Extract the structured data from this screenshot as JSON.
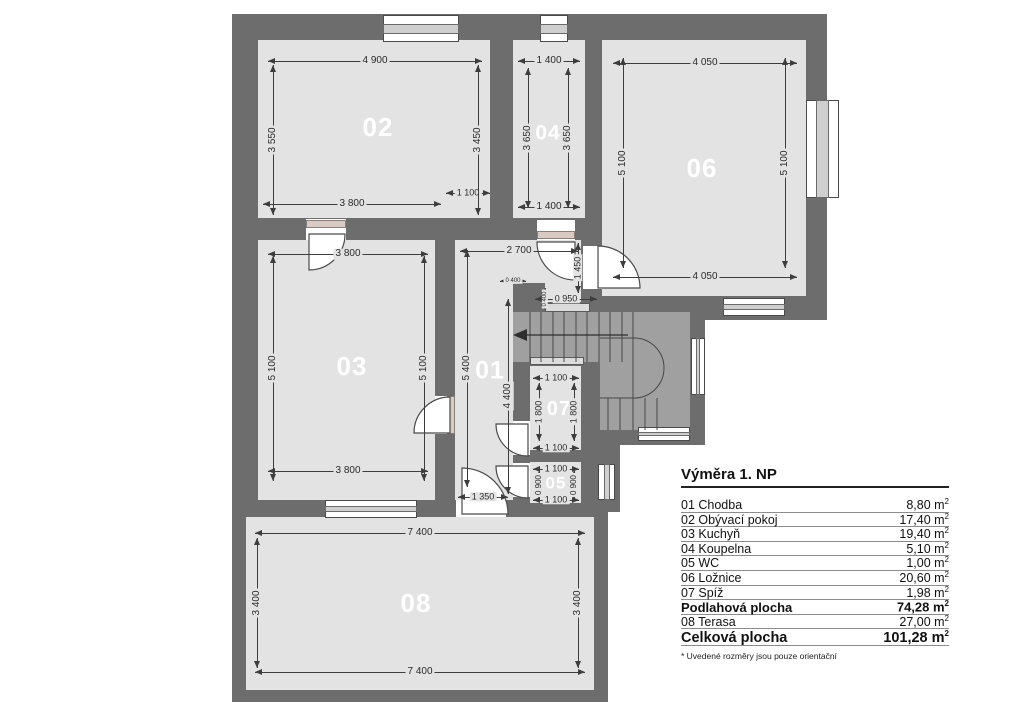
{
  "drawing": {
    "type": "floor-plan",
    "floor": "1. NP"
  },
  "legend": {
    "title": "Výměra 1. NP",
    "unit": "m",
    "unit_sup": "2",
    "rows": [
      {
        "label": "01 Chodba",
        "area": "8,80",
        "bold": false,
        "big": false
      },
      {
        "label": "02 Obývací pokoj",
        "area": "17,40",
        "bold": false,
        "big": false
      },
      {
        "label": "03 Kuchyň",
        "area": "19,40",
        "bold": false,
        "big": false
      },
      {
        "label": "04 Koupelna",
        "area": "5,10",
        "bold": false,
        "big": false
      },
      {
        "label": "05 WC",
        "area": "1,00",
        "bold": false,
        "big": false
      },
      {
        "label": "06 Ložnice",
        "area": "20,60",
        "bold": false,
        "big": false
      },
      {
        "label": "07 Spíž",
        "area": "1,98",
        "bold": false,
        "big": false
      },
      {
        "label": "Podlahová plocha",
        "area": "74,28",
        "bold": true,
        "big": false
      },
      {
        "label": "08 Terasa",
        "area": "27,00",
        "bold": false,
        "big": false
      },
      {
        "label": "Celková plocha",
        "area": "101,28",
        "bold": true,
        "big": true
      }
    ],
    "footnote": "* Uvedené rozměry jsou pouze orientační"
  },
  "rooms": [
    {
      "number": "02",
      "name": "Obývací pokoj",
      "x": 378,
      "y": 127,
      "size": 26
    },
    {
      "number": "04",
      "name": "Koupelna",
      "x": 548,
      "y": 133,
      "size": 21
    },
    {
      "number": "06",
      "name": "Ložnice",
      "x": 702,
      "y": 168,
      "size": 26
    },
    {
      "number": "03",
      "name": "Kuchyň",
      "x": 352,
      "y": 366,
      "size": 26
    },
    {
      "number": "01",
      "name": "Chodba",
      "x": 490,
      "y": 371,
      "size": 25
    },
    {
      "number": "07",
      "name": "Spíž",
      "x": 559,
      "y": 409,
      "size": 20
    },
    {
      "number": "05",
      "name": "WC",
      "x": 556,
      "y": 483,
      "size": 17
    },
    {
      "number": "08",
      "name": "Terasa",
      "x": 416,
      "y": 603,
      "size": 26
    }
  ],
  "dimensions": [
    {
      "text": "4 900",
      "o": "h",
      "x": 375,
      "y": 61,
      "len": 214
    },
    {
      "text": "1 400",
      "o": "h",
      "x": 549,
      "y": 61,
      "len": 62
    },
    {
      "text": "4 050",
      "o": "h",
      "x": 705,
      "y": 63,
      "len": 184
    },
    {
      "text": "1 100",
      "o": "h",
      "x": 468,
      "y": 193,
      "len": 44,
      "fs": 9
    },
    {
      "text": "3 800",
      "o": "h",
      "x": 352,
      "y": 204,
      "len": 178
    },
    {
      "text": "1 400",
      "o": "h",
      "x": 549,
      "y": 207,
      "len": 62
    },
    {
      "text": "3 800",
      "o": "h",
      "x": 348,
      "y": 254,
      "len": 160
    },
    {
      "text": "2 700",
      "o": "h",
      "x": 519,
      "y": 251,
      "len": 118
    },
    {
      "text": "0 400",
      "o": "h",
      "x": 513,
      "y": 281,
      "len": 26,
      "fs": 6
    },
    {
      "text": "0 950",
      "o": "h",
      "x": 566,
      "y": 299,
      "len": 62,
      "fs": 9
    },
    {
      "text": "4 050",
      "o": "h",
      "x": 705,
      "y": 277,
      "len": 184
    },
    {
      "text": "1 100",
      "o": "h",
      "x": 556,
      "y": 378,
      "len": 46,
      "fs": 9
    },
    {
      "text": "1 100",
      "o": "h",
      "x": 556,
      "y": 448,
      "len": 46,
      "fs": 9
    },
    {
      "text": "1 100",
      "o": "h",
      "x": 556,
      "y": 469,
      "len": 46,
      "fs": 9
    },
    {
      "text": "1 100",
      "o": "h",
      "x": 556,
      "y": 500,
      "len": 46,
      "fs": 9
    },
    {
      "text": "1 350",
      "o": "h",
      "x": 483,
      "y": 497,
      "len": 50,
      "fs": 9
    },
    {
      "text": "3 800",
      "o": "h",
      "x": 348,
      "y": 471,
      "len": 160
    },
    {
      "text": "7 400",
      "o": "h",
      "x": 420,
      "y": 533,
      "len": 330
    },
    {
      "text": "7 400",
      "o": "h",
      "x": 420,
      "y": 672,
      "len": 330
    },
    {
      "text": "3 550",
      "o": "v",
      "x": 273,
      "y": 140,
      "len": 150
    },
    {
      "text": "3 450",
      "o": "v",
      "x": 478,
      "y": 140,
      "len": 150
    },
    {
      "text": "3 650",
      "o": "v",
      "x": 528,
      "y": 138,
      "len": 140
    },
    {
      "text": "3 650",
      "o": "v",
      "x": 568,
      "y": 138,
      "len": 140
    },
    {
      "text": "5 100",
      "o": "v",
      "x": 623,
      "y": 163,
      "len": 210
    },
    {
      "text": "5 100",
      "o": "v",
      "x": 785,
      "y": 163,
      "len": 210
    },
    {
      "text": "5 100",
      "o": "v",
      "x": 273,
      "y": 368,
      "len": 225
    },
    {
      "text": "5 100",
      "o": "v",
      "x": 424,
      "y": 368,
      "len": 225
    },
    {
      "text": "5 400",
      "o": "v",
      "x": 467,
      "y": 368,
      "len": 237
    },
    {
      "text": "4 400",
      "o": "v",
      "x": 508,
      "y": 396,
      "len": 195
    },
    {
      "text": "1 450",
      "o": "v",
      "x": 578,
      "y": 268,
      "len": 50,
      "fs": 9
    },
    {
      "text": "0 400",
      "o": "v",
      "x": 545,
      "y": 299,
      "len": 22,
      "fs": 6
    },
    {
      "text": "1 800",
      "o": "v",
      "x": 539,
      "y": 412,
      "len": 58,
      "fs": 9
    },
    {
      "text": "1 800",
      "o": "v",
      "x": 574,
      "y": 412,
      "len": 58,
      "fs": 9
    },
    {
      "text": "0 900",
      "o": "v",
      "x": 539,
      "y": 485,
      "len": 28,
      "fs": 8
    },
    {
      "text": "0 900",
      "o": "v",
      "x": 574,
      "y": 485,
      "len": 28,
      "fs": 8
    },
    {
      "text": "3 400",
      "o": "v",
      "x": 257,
      "y": 603,
      "len": 130
    },
    {
      "text": "3 400",
      "o": "v",
      "x": 578,
      "y": 603,
      "len": 130
    }
  ],
  "colors": {
    "wall": "#6d6d6d",
    "room_fill": "#e3e3e3",
    "stair_fill": "#a0a0a0",
    "dim_line": "#3d3d3d",
    "room_label": "#ffffff"
  }
}
